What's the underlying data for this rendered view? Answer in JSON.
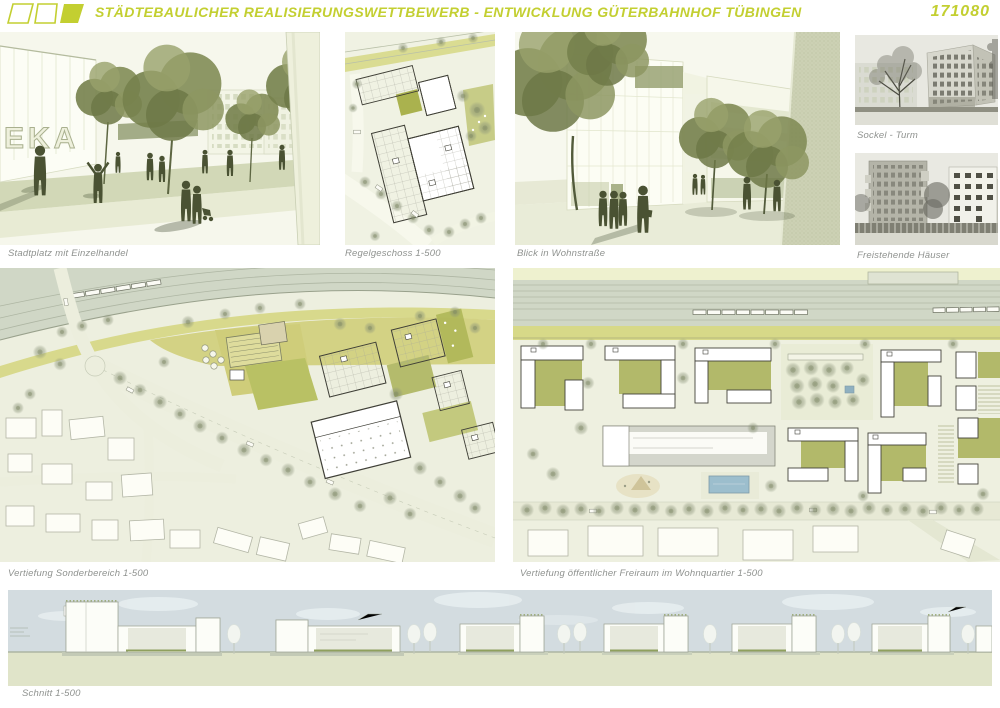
{
  "board": {
    "title": "STÄDTEBAULICHER REALISIERUNGSWETTBEWERB - ENTWICKLUNG GÜTERBAHNHOF TÜBINGEN",
    "entry_number": "171080",
    "accent_color": "#c3cf31",
    "caption_color": "#8f928f",
    "logo_shapes": [
      "parallelogram-outline",
      "square-outline",
      "parallelogram-filled"
    ]
  },
  "figures": {
    "stadtplatz": {
      "caption": "Stadtplatz mit Einzelhandel",
      "signage": "EKA"
    },
    "regelgeschoss": {
      "caption": "Regelgeschoss 1-500"
    },
    "wohnstrasse": {
      "caption": "Blick in Wohnstraße"
    },
    "sockel_turm": {
      "caption": "Sockel - Turm"
    },
    "freistehende_haeuser": {
      "caption": "Freistehende Häuser"
    },
    "sonderbereich": {
      "caption": "Vertiefung Sonderbereich 1-500"
    },
    "wohnquartier_freiraum": {
      "caption": "Vertiefung öffentlicher Freiraum im Wohnquartier 1-500"
    },
    "schnitt": {
      "caption": "Schnitt 1-500"
    }
  }
}
